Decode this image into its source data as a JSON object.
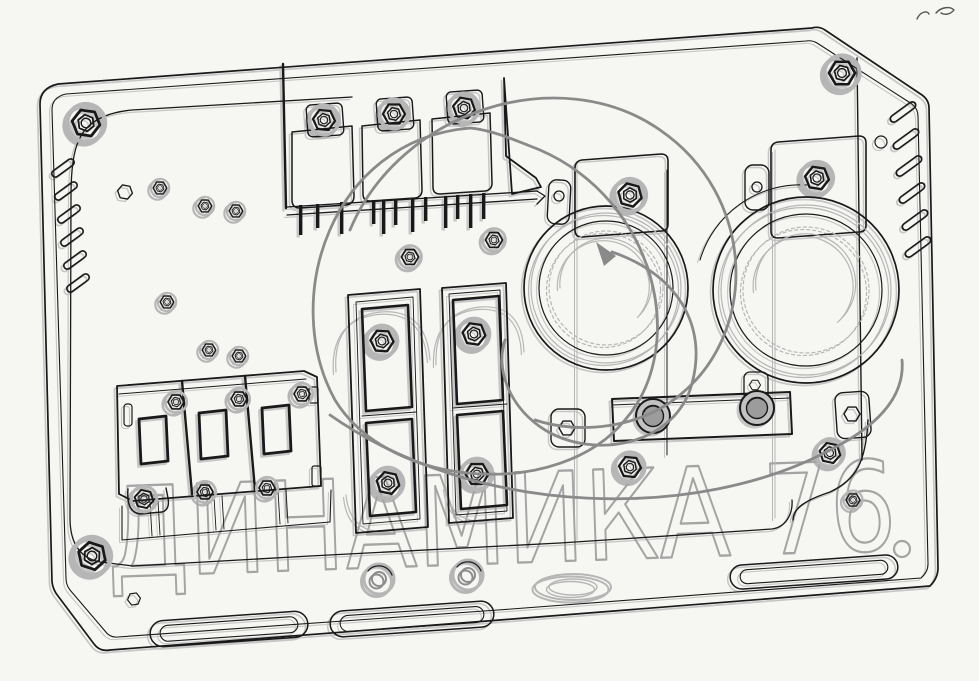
{
  "canvas": {
    "width": 979,
    "height": 681,
    "background": "#f6f6f3"
  },
  "colors": {
    "bg": "#f6f6f3",
    "ink": "#191919",
    "ghost": "#c6c6c6",
    "gray": "#b6b6b6",
    "swirl": "#8a8a8a",
    "wm": "#a4a4a4"
  },
  "watermark": {
    "text": "ДИНАМИКА 76",
    "swirl_shape": "trefoil-loop-swirl-with-arrow",
    "dot": "small-circle"
  },
  "diagram": {
    "type": "technical-line-drawing",
    "subject": "electrical-equipment-mounting-panel",
    "parts": {
      "panel": "mounting panel plate with beveled corners",
      "vent_slots_left": 6,
      "vent_slots_right": 6,
      "relay_block": {
        "relays": 3,
        "pins": 12
      },
      "fuse_strips": 2,
      "round_devices": 2,
      "busbar_terminals": 2,
      "breakers": 3,
      "cable_slots": 3,
      "grommets": 2,
      "corner_bolts": 3
    }
  }
}
